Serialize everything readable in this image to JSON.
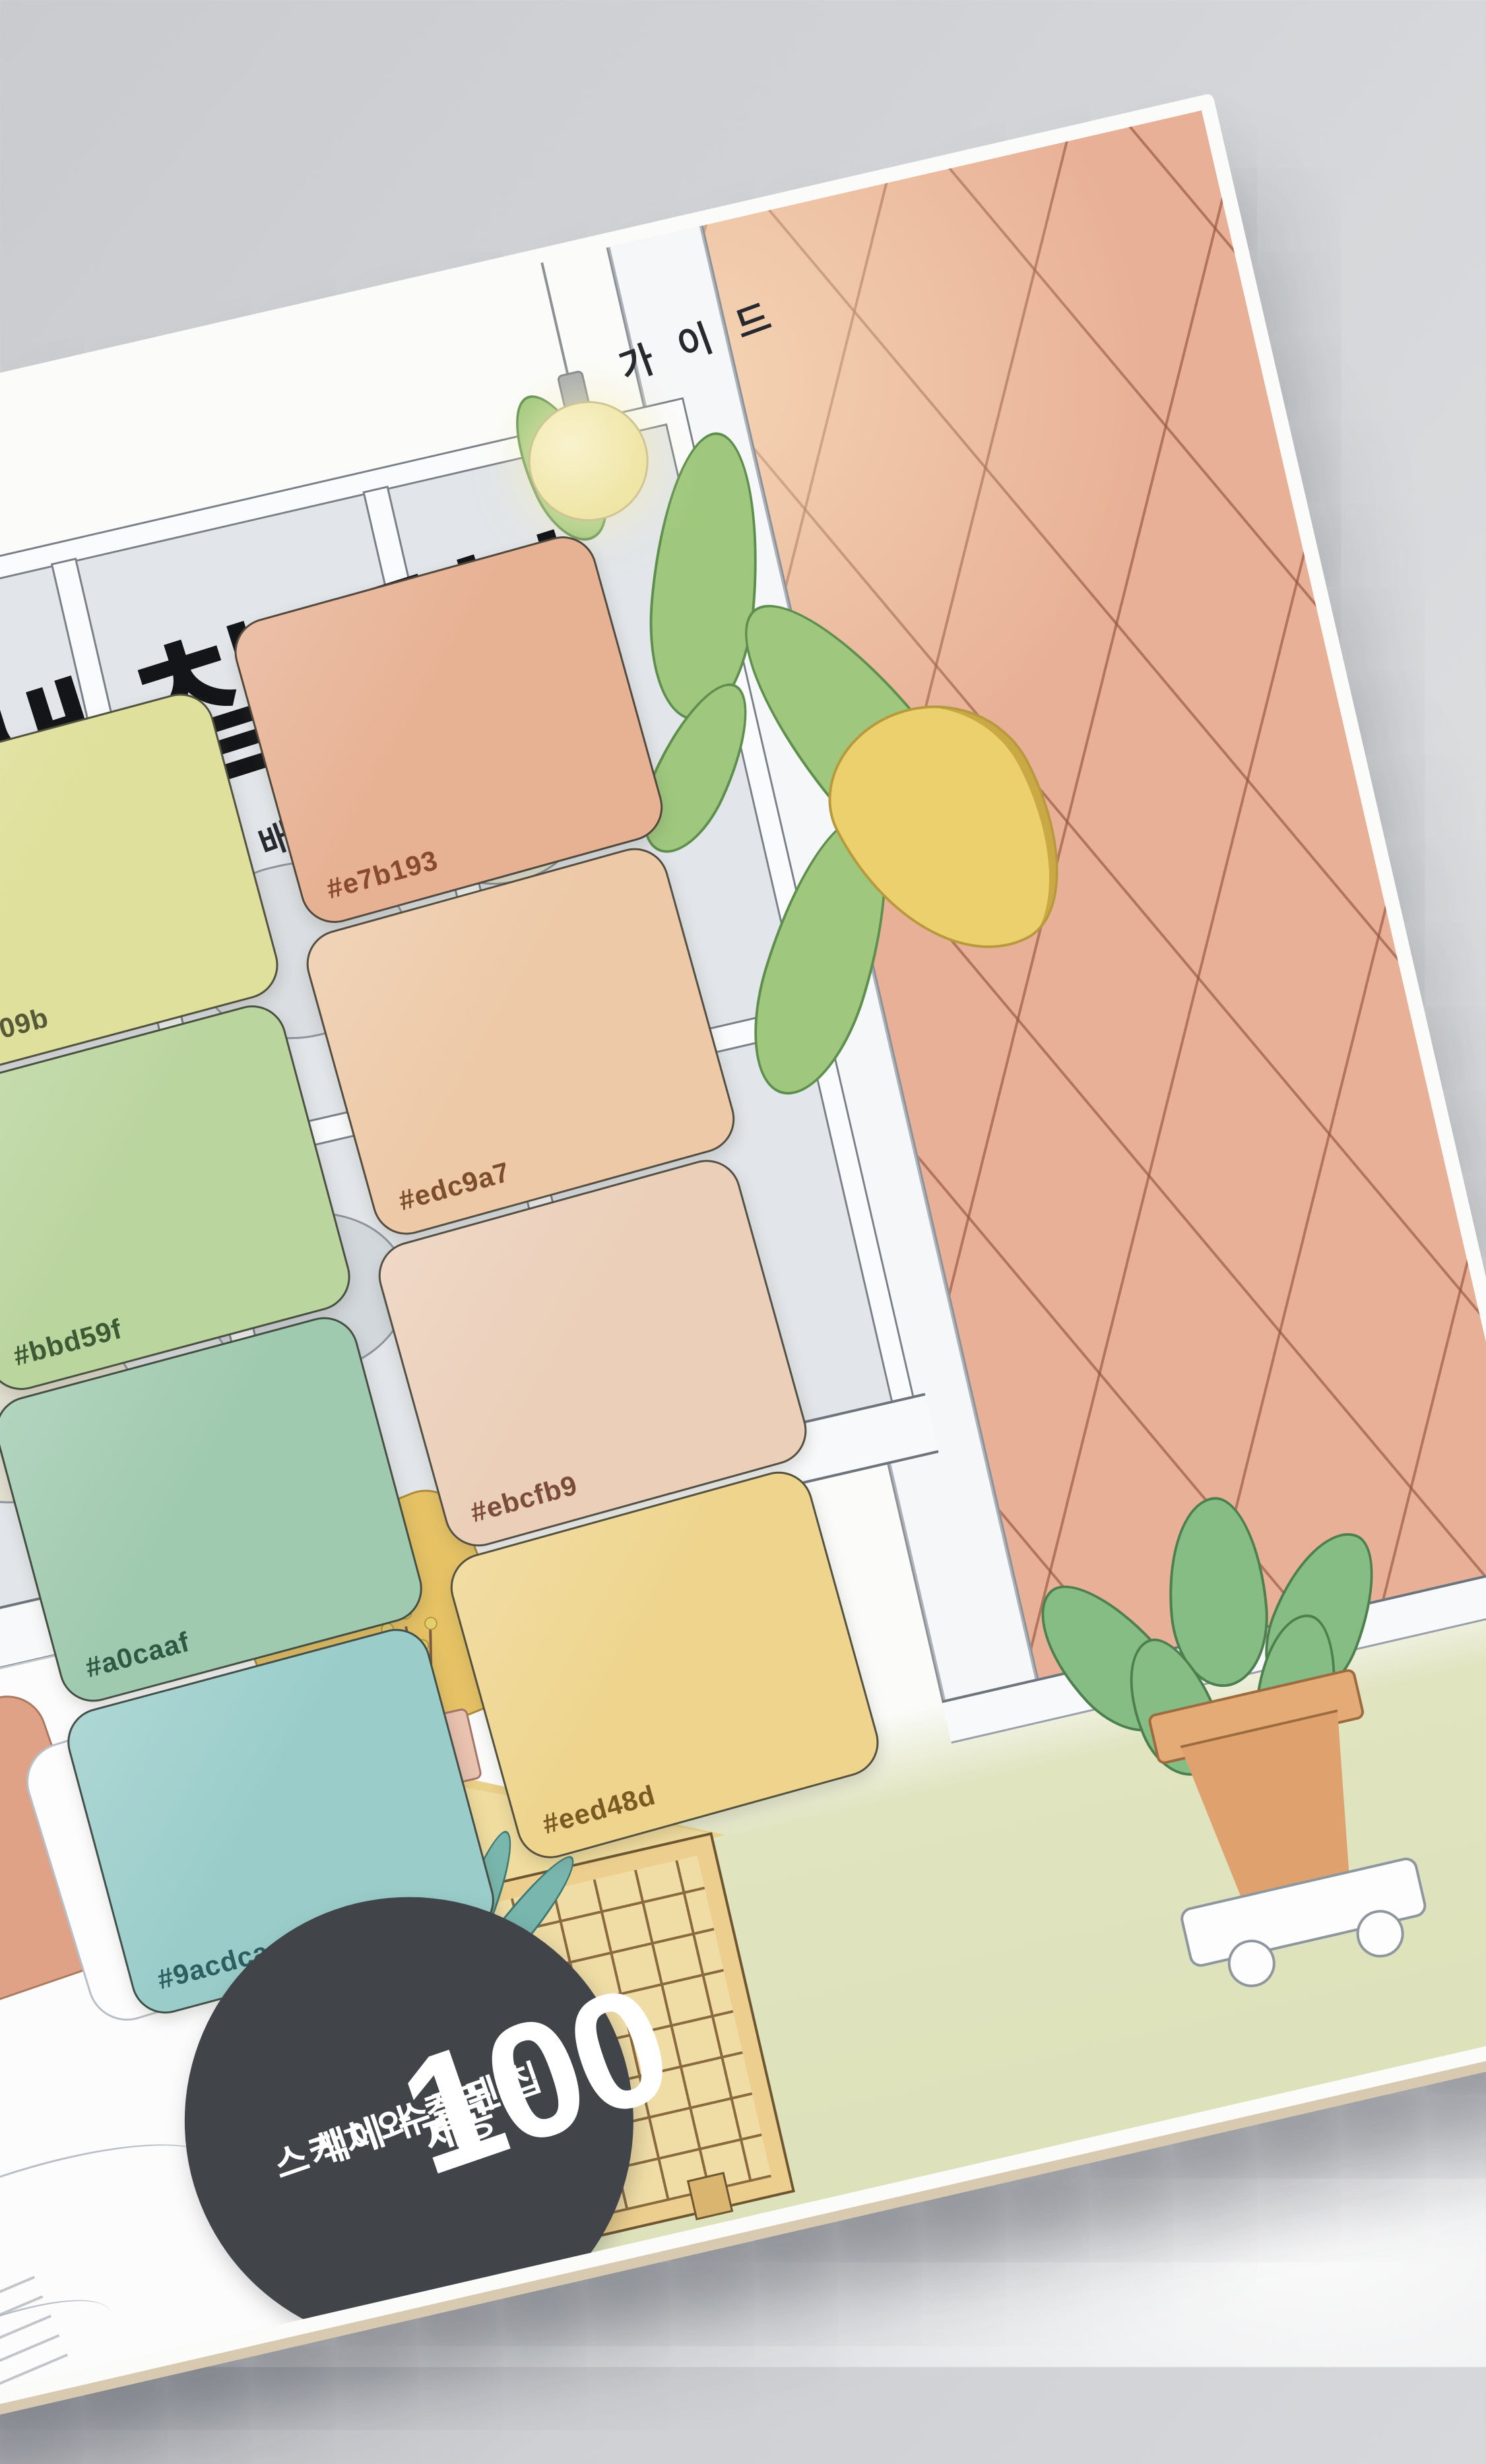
{
  "photo": {
    "background_color": "#d3d5d8",
    "description_colors": {
      "book_page_edge": "#dcc6b8"
    }
  },
  "book": {
    "rotation_deg": -13,
    "cover_bg": "#fbfbfa",
    "title": "색,칠,공부",
    "subtitle": "드로잉이 재미있어지는 배색과 채색",
    "subtitle_tail": "가이드",
    "swatches": [
      {
        "label": "#dfe09b",
        "fill": "#dfe09b",
        "label_color": "#565a38",
        "column": "left",
        "row": 1
      },
      {
        "label": "#e7b193",
        "fill": "#e7b193",
        "label_color": "#8a4a2e",
        "column": "right",
        "row": 1
      },
      {
        "label": "#bbd59f",
        "fill": "#bbd59f",
        "label_color": "#3c5a33",
        "column": "left",
        "row": 2
      },
      {
        "label": "#edc9a7",
        "fill": "#edc9a7",
        "label_color": "#7c4e2b",
        "column": "right",
        "row": 2
      },
      {
        "label": "#a0caaf",
        "fill": "#a0caaf",
        "label_color": "#2e5942",
        "column": "left",
        "row": 3
      },
      {
        "label": "#ebcfb9",
        "fill": "#ebcfb9",
        "label_color": "#7b4d39",
        "column": "right",
        "row": 3
      },
      {
        "label": "#9acdca",
        "fill": "#9acdca",
        "label_color": "#2d5e62",
        "column": "left",
        "row": 4
      },
      {
        "label": "#eed48d",
        "fill": "#eed48d",
        "label_color": "#7a5a22",
        "column": "right",
        "row": 4
      }
    ],
    "badge": {
      "line1": "책에 수록된",
      "line2": "스케치와 컬러 칩",
      "number": "100",
      "unit": "개",
      "suffix": "제공",
      "bg": "#41454a",
      "text_color": "#ffffff"
    },
    "illustration": {
      "brick_color": "#e8b096",
      "floor_color": "#dfe3bd",
      "glass_color": "#e2e5e9",
      "bulb_color": "#f3ebb6"
    }
  }
}
